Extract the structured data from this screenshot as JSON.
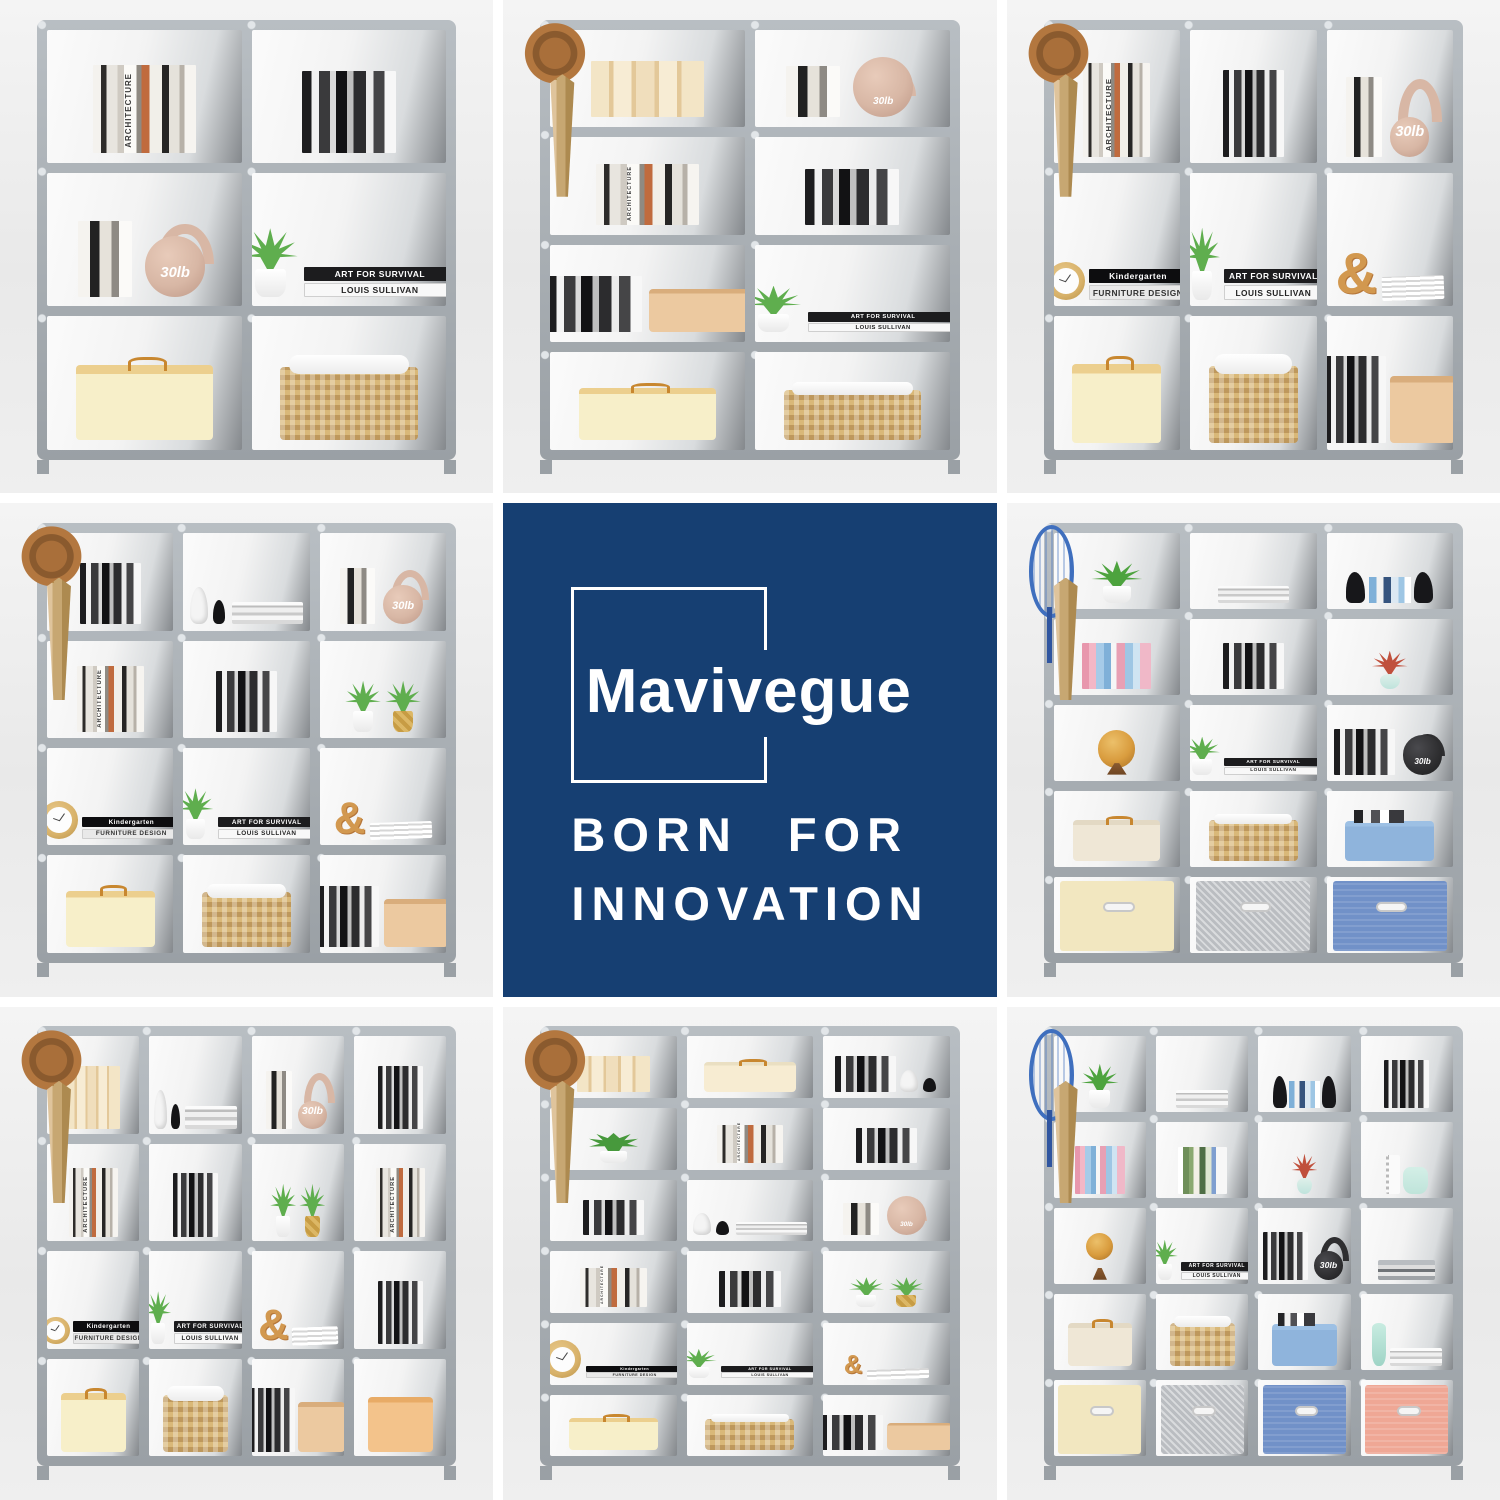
{
  "canvas": {
    "width": 1500,
    "height": 1500,
    "background": "#FFFFFF",
    "tile_gap_px": 10,
    "grid": "3x3"
  },
  "brand_tile": {
    "grid_position": "center",
    "background_color": "#163F72",
    "text_color": "#FFFFFF",
    "logo_name": "Mavivegue",
    "tagline_line1": "BORN FOR",
    "tagline_line2": "INNOVATION"
  },
  "labels": {
    "kettlebell_weight": "30lb",
    "art_book_top": "ART FOR SURVIVAL",
    "art_book_bottom": "LOUIS SULLIVAN",
    "kinder_book_top": "Kindergarten",
    "kinder_book_bottom": "FURNITURE DESIGN",
    "ampersand": "&",
    "spine_architecture": "ARCHITECTURE",
    "spine_innenarchitektur": "INNENARCHITEKTUR",
    "spine_design_gadgets": "DESIGN GADGETS",
    "spine_fashion": "THE FASHION ICON",
    "spine_dior": "DIOR NEW LOOK REVOLUTION"
  },
  "palette": {
    "frame_tube": "#A9AFB4",
    "connector_silver": "#E2E6E9",
    "fabric_panel_gray": "#84888C",
    "photo_background": "#ECECEC",
    "basket_tan": "#D9B878",
    "box_yellow": "#F7EFC9",
    "box_orange": "#F3C38B",
    "bin_blue": "#8FB4DC",
    "drawer_cream": "#F2E7C0",
    "drawer_gray": "#BABDC1",
    "drawer_blue": "#7191C8",
    "drawer_pink": "#EFA795",
    "kettlebell_tan": "#D8B7A5",
    "kettlebell_black": "#2E2E30",
    "plant_green": "#5FAE4E",
    "plant_red": "#C0503C"
  },
  "tiles": [
    {
      "type": "photo",
      "grid_position": "top-left",
      "cube_columns": 2,
      "cube_rows": 3,
      "cube_count": 6,
      "accessories": [],
      "cells": [
        [
          "books"
        ],
        [
          "booksBW"
        ],
        [
          "booksFew",
          "kettlebellTan"
        ],
        [
          "plant",
          "artBooks"
        ],
        [
          "boxYellow"
        ],
        [
          "basket"
        ]
      ]
    },
    {
      "type": "photo",
      "grid_position": "top-center",
      "cube_columns": 2,
      "cube_rows": 4,
      "cube_count": 8,
      "accessories": [
        "hat",
        "umbrella"
      ],
      "cells": [
        [
          "folders"
        ],
        [
          "booksFew",
          "kettlebellTan"
        ],
        [
          "books"
        ],
        [
          "booksBW"
        ],
        [
          "booksBW",
          "boxCardboard"
        ],
        [
          "plant",
          "artBooks"
        ],
        [
          "boxYellow"
        ],
        [
          "basket"
        ]
      ]
    },
    {
      "type": "photo",
      "grid_position": "top-right",
      "cube_columns": 3,
      "cube_rows": 3,
      "cube_count": 9,
      "accessories": [
        "hat",
        "umbrella"
      ],
      "cells": [
        [
          "books"
        ],
        [
          "booksBW"
        ],
        [
          "booksFew",
          "kettlebellTan"
        ],
        [
          "clock",
          "kinderBooks"
        ],
        [
          "plant",
          "artBooks"
        ],
        [
          "ampersand",
          "magazines"
        ],
        [
          "boxYellow"
        ],
        [
          "basket"
        ],
        [
          "booksBW",
          "boxCardboard"
        ]
      ]
    },
    {
      "type": "photo",
      "grid_position": "middle-left",
      "cube_columns": 3,
      "cube_rows": 4,
      "cube_count": 12,
      "accessories": [
        "hat",
        "umbrella"
      ],
      "cells": [
        [
          "booksBW"
        ],
        [
          "statue",
          "bookstack"
        ],
        [
          "booksFew",
          "kettlebellTan"
        ],
        [
          "books"
        ],
        [
          "booksBW"
        ],
        [
          "plant",
          "plantGold"
        ],
        [
          "clock",
          "kinderBooks"
        ],
        [
          "plant",
          "artBooks"
        ],
        [
          "ampersand",
          "magazines"
        ],
        [
          "boxYellow"
        ],
        [
          "basket"
        ],
        [
          "booksBW",
          "boxCardboard"
        ]
      ]
    },
    {
      "type": "brand",
      "grid_position": "center"
    },
    {
      "type": "photo",
      "grid_position": "middle-right",
      "cube_columns": 3,
      "cube_rows": 5,
      "cube_count": 15,
      "accessories": [
        "racket",
        "umbrella"
      ],
      "cells": [
        [
          "plantVine"
        ],
        [
          "bookstack"
        ],
        [
          "bookends"
        ],
        [
          "booksColor"
        ],
        [
          "booksBW"
        ],
        [
          "plantRed"
        ],
        [
          "globe"
        ],
        [
          "plant",
          "artBooks"
        ],
        [
          "booksBW",
          "kettlebellBlack"
        ],
        [
          "boxBeige"
        ],
        [
          "basket"
        ],
        [
          "binBlue"
        ],
        [
          "drawerCream"
        ],
        [
          "drawerGray"
        ],
        [
          "drawerBlue"
        ]
      ]
    },
    {
      "type": "photo",
      "grid_position": "bottom-left",
      "cube_columns": 4,
      "cube_rows": 4,
      "cube_count": 16,
      "accessories": [
        "hat",
        "umbrella"
      ],
      "cells": [
        [
          "folders"
        ],
        [
          "statue",
          "bookstack"
        ],
        [
          "booksFew",
          "kettlebellTan"
        ],
        [
          "booksBW"
        ],
        [
          "books"
        ],
        [
          "booksBW"
        ],
        [
          "plant",
          "plantGold"
        ],
        [
          "books"
        ],
        [
          "clock",
          "kinderBooks"
        ],
        [
          "plant",
          "artBooks"
        ],
        [
          "ampersand",
          "magazines"
        ],
        [
          "booksBW"
        ],
        [
          "boxYellow"
        ],
        [
          "basket"
        ],
        [
          "booksBW",
          "boxCardboard"
        ],
        [
          "boxOrange"
        ]
      ]
    },
    {
      "type": "photo",
      "grid_position": "bottom-center",
      "cube_columns": 3,
      "cube_rows": 6,
      "cube_count": 18,
      "accessories": [
        "hat",
        "umbrella"
      ],
      "cells": [
        [
          "folders"
        ],
        [
          "boxCream"
        ],
        [
          "booksBW",
          "statue"
        ],
        [
          "plantBush"
        ],
        [
          "books"
        ],
        [
          "booksBW"
        ],
        [
          "booksBW"
        ],
        [
          "statue",
          "bookstack"
        ],
        [
          "booksFew",
          "kettlebellTan"
        ],
        [
          "books"
        ],
        [
          "booksBW"
        ],
        [
          "plant",
          "plantGold"
        ],
        [
          "clock",
          "kinderBooks"
        ],
        [
          "plant",
          "artBooks"
        ],
        [
          "ampersand",
          "magazines"
        ],
        [
          "boxYellow"
        ],
        [
          "basket"
        ],
        [
          "booksBW",
          "boxCardboard"
        ]
      ]
    },
    {
      "type": "photo",
      "grid_position": "bottom-right",
      "cube_columns": 4,
      "cube_rows": 5,
      "cube_count": 20,
      "accessories": [
        "racket",
        "umbrella"
      ],
      "cells": [
        [
          "plantVine"
        ],
        [
          "bookstack"
        ],
        [
          "bookends"
        ],
        [
          "booksBW"
        ],
        [
          "booksColor"
        ],
        [
          "booksGreen"
        ],
        [
          "plantRed"
        ],
        [
          "notebook",
          "tealJar"
        ],
        [
          "globe"
        ],
        [
          "plant",
          "artBooks"
        ],
        [
          "booksBW",
          "kettlebellBlack"
        ],
        [
          "bookstackGray"
        ],
        [
          "boxBeige"
        ],
        [
          "basket"
        ],
        [
          "binBlue"
        ],
        [
          "tealVase",
          "bookstack"
        ],
        [
          "drawerCream"
        ],
        [
          "drawerGray"
        ],
        [
          "drawerBlue"
        ],
        [
          "drawerPink"
        ]
      ]
    }
  ]
}
